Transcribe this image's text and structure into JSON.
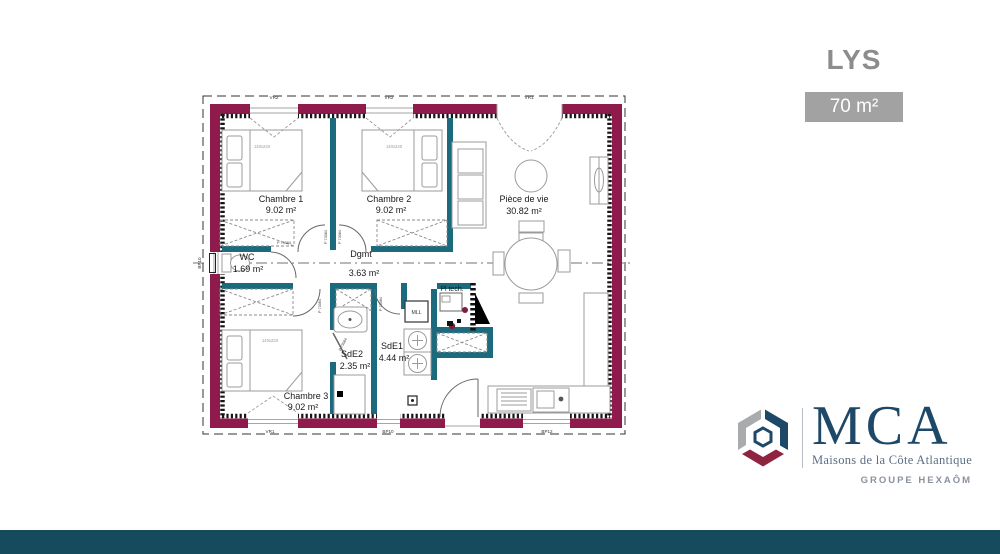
{
  "header": {
    "plan_name": "LYS",
    "area_badge": "70 m²"
  },
  "plan": {
    "rooms": [
      {
        "name": "Chambre 1",
        "area": "9.02 m²"
      },
      {
        "name": "Chambre 2",
        "area": "9.02 m²"
      },
      {
        "name": "Pièce de vie",
        "area": "30.82 m²"
      },
      {
        "name": "WC",
        "area": "1.69 m²"
      },
      {
        "name": "Dgmt",
        "area": "3.63 m²"
      },
      {
        "name": "SdE2",
        "area": "2.35 m²"
      },
      {
        "name": "SdE1",
        "area": "4.44 m²"
      },
      {
        "name": "Chambre 3",
        "area": "9.02 m²"
      },
      {
        "name": "Pl tech.",
        "area": ""
      }
    ],
    "bed_size_label": "140x220",
    "door_code": "P 73084",
    "washing_machine_label": "MLL",
    "window_labels": {
      "top": [
        "VR2",
        "VR2",
        "VR1"
      ],
      "bottom": [
        "VR1",
        "BP10",
        "BP12"
      ],
      "left": "BP10"
    }
  },
  "branding": {
    "logo_text": "MCA",
    "logo_subtitle": "Maisons de la Côte Atlantique",
    "group_label": "GROUPE HEXAÔM"
  },
  "colors": {
    "exterior_wall": "#8F1B4D",
    "partition_wall": "#1B6A7D",
    "footer_band": "#154B5D",
    "brand_navy": "#1D4868",
    "brand_red": "#8E2440",
    "brand_gray": "#A9ABAD",
    "title_gray": "#8C8C8C",
    "badge_bg": "#A2A2A2"
  }
}
